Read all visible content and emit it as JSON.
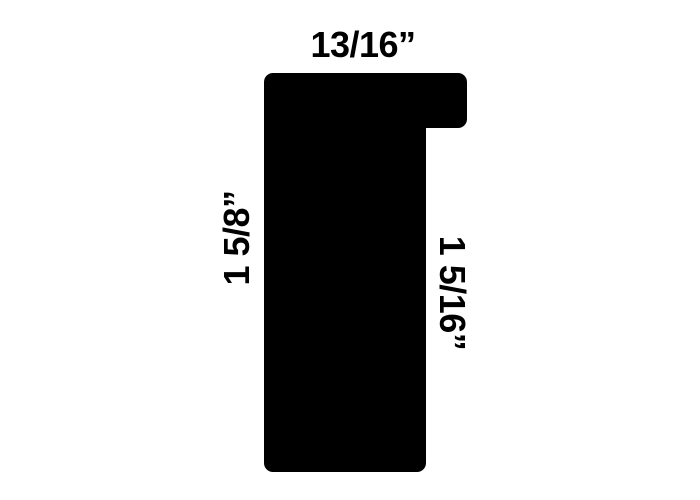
{
  "page": {
    "background_color": "#ffffff"
  },
  "diagram": {
    "name": "picture-frame-moulding-profile-cross-section",
    "shape_color": "#000000",
    "labels": {
      "top_width": "13/16”",
      "left_height": "1 5/8”",
      "right_rabbet_depth": "1 5/16”"
    }
  }
}
